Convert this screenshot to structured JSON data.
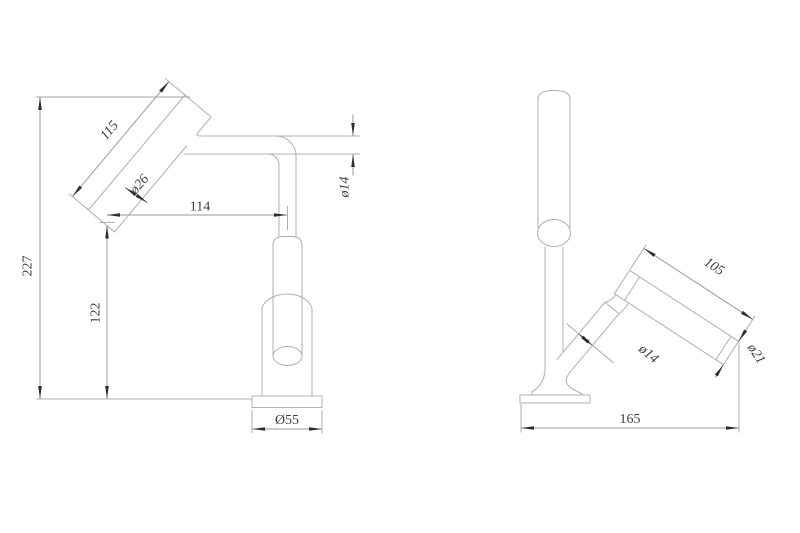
{
  "colors": {
    "background": "#ffffff",
    "geometry_line": "#b0b0b0",
    "dimension_line": "#9a9a9a",
    "text": "#3f3f3f",
    "arrow": "#2e2e2e"
  },
  "front_view": {
    "dimensions": {
      "overall_height": "227",
      "head_length": "115",
      "head_diameter": "ø26",
      "horizontal_reach": "114",
      "outlet_height": "122",
      "arm_diameter": "ø14",
      "base_diameter": "Ø55"
    }
  },
  "side_view": {
    "dimensions": {
      "head_length": "105",
      "post_diameter": "ø14",
      "head_end_diameter": "ø21",
      "overall_depth": "165"
    }
  }
}
